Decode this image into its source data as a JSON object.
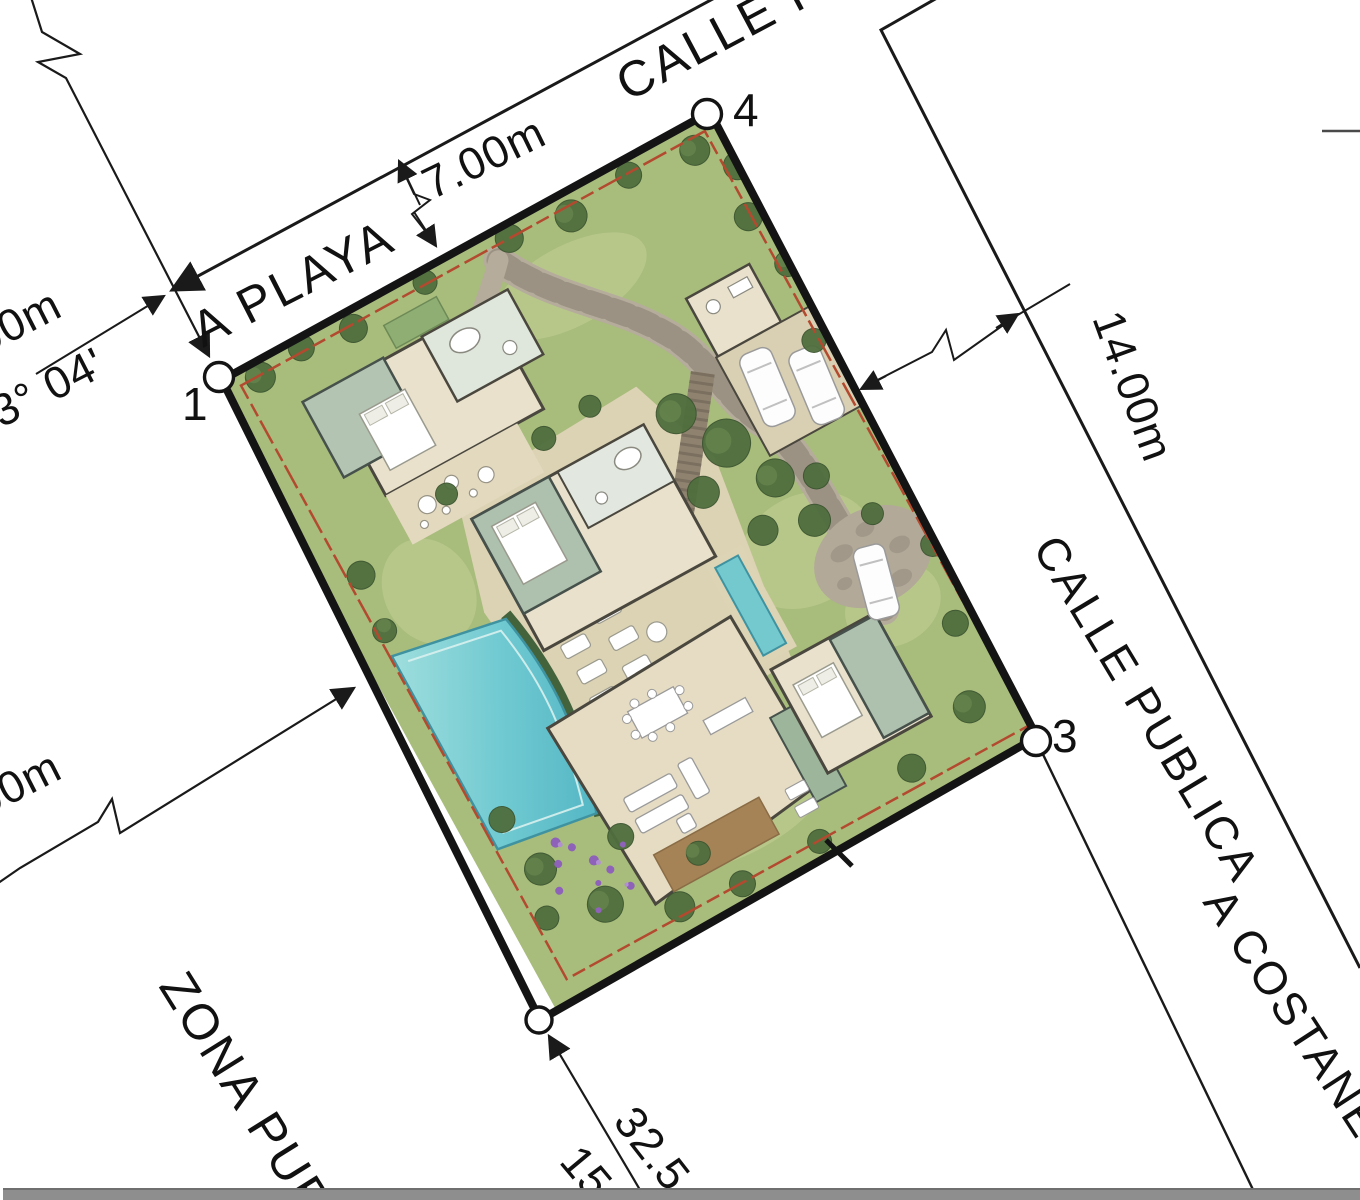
{
  "plan": {
    "title": "villa-site-plan",
    "roads": {
      "top_street": "CALLE PU",
      "right_street": "CALLE PUBLICA",
      "to_beach": "A PLAYA",
      "to_coastal": "A COSTANERA",
      "public_zone": "ZONA PUB"
    },
    "dimensions": {
      "top_road_width": "7.00m",
      "right_road_width": "14.00m",
      "left_distance": "00m",
      "left_bearing": "33° 04'",
      "lower_left_distance": "00m",
      "bottom_distance": "32.5",
      "bottom_bearing": "15"
    },
    "points": {
      "p1": "1",
      "p3": "3",
      "p4": "4"
    },
    "colors": {
      "boundary_black": "#141414",
      "setback_red": "#b34a2f",
      "grass_green": "#a8bc7c",
      "pool_cyan": "#6fc9d1",
      "annotation_black": "#1a1a1a",
      "scrollbar_gray": "#8e8e8e"
    }
  }
}
